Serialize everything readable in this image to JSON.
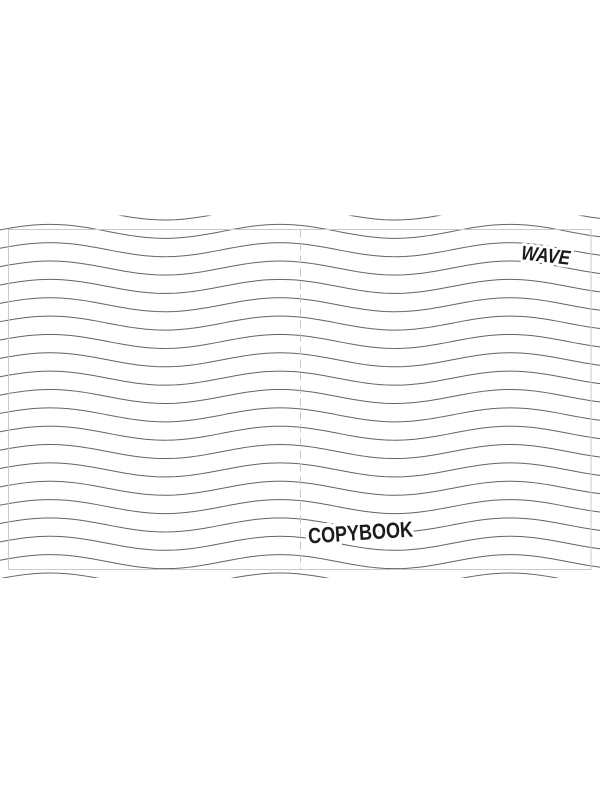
{
  "cover": {
    "brand": "WAVE",
    "title": "COPYBOOK"
  },
  "pattern": {
    "type": "wavy-ruled-lines",
    "background": "#ffffff",
    "line_color": "#646464",
    "line_width": 1,
    "band_top": 215.5,
    "band_bottom": 578,
    "first_line_y": 213,
    "line_spacing": 18.35,
    "line_count": 21,
    "amplitude": 7,
    "wavelength": 230,
    "crest_x": 50
  },
  "guides": {
    "trim_box": {
      "x": 8.5,
      "y": 229.5,
      "width": 582.5,
      "height": 340,
      "color": "#c9c9c9"
    },
    "fold_line": {
      "x": 300.5,
      "top": 229.5,
      "bottom": 569.5,
      "color": "#c6c6c6",
      "dash": "8 5"
    }
  },
  "labels": {
    "brand": {
      "x": 545,
      "y": 262,
      "rotation": 6.5,
      "font_size": 20,
      "text_length": 49,
      "color": "#1b1b1b"
    },
    "title": {
      "x": 361,
      "y": 540,
      "rotation": -3.8,
      "font_size": 22,
      "text_length": 105,
      "color": "#1b1b1b"
    }
  }
}
